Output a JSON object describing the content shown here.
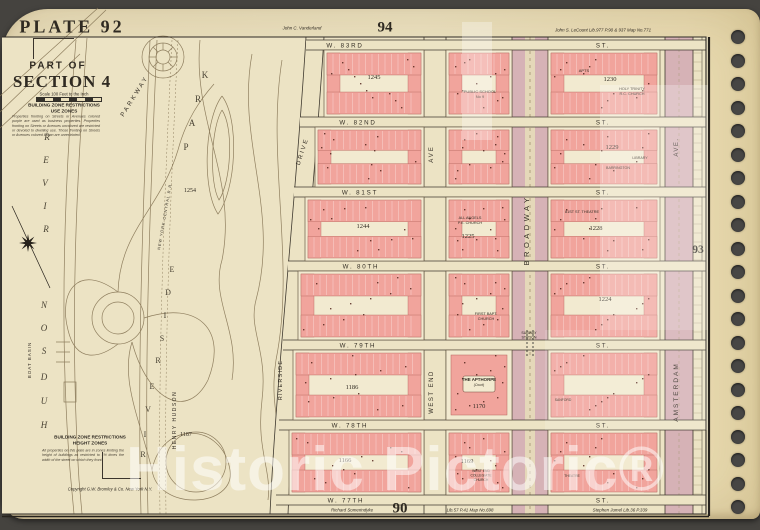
{
  "header": {
    "plate_label": "PLATE 92",
    "part_of": "PART OF",
    "section": "SECTION 4",
    "scale_note": "Scale 100 Feet to the Inch",
    "use_zone_title": "BUILDING ZONE RESTRICTIONS",
    "use_zone_sub": "USE ZONES",
    "use_zone_note": "Properties fronting on Streets or Avenues colored purple are used as business properties. Properties fronting on Streets or Avenues uncolored are restricted or devoted to dwelling use. Those fronting on Streets or Avenues colored brown are unrestricted.",
    "height_zone_title": "BUILDING ZONE RESTRICTIONS",
    "height_zone_sub": "HEIGHT ZONES",
    "height_zone_note": "All properties on this plate are in zones limiting the height of buildings as restricted to 1½ times the width of the street on which they front.",
    "copyright": "Copyright G.W. Bromley & Co. New York N.Y."
  },
  "margins": {
    "plate_top": "94",
    "plate_right": "93",
    "plate_bottom": "90",
    "top_left_text": "John C. Vanderland",
    "top_right_text": "John S. LeCount Lib.977 P.90 & 937 Map No.771",
    "bottom_text_1": "Richard Somerindyke",
    "bottom_text_2": "Lib.57 P.41 Map No.698",
    "bottom_text_3": "Stephen Jumel Lib.36 P.339"
  },
  "watermark": {
    "text": "Historic Pictoric®"
  },
  "binding": {
    "x": 731,
    "y0": 30,
    "step": 23.5,
    "count": 21
  },
  "overlays": [
    {
      "x": 462,
      "y": 22,
      "w": 30,
      "h": 118,
      "a": 0.3
    },
    {
      "x": 600,
      "y": 85,
      "w": 108,
      "h": 245,
      "a": 0.26
    },
    {
      "x": 545,
      "y": 330,
      "w": 163,
      "h": 100,
      "a": 0.14
    }
  ],
  "map": {
    "colors": {
      "face": "#ece3c4",
      "lot": "#f2ead0",
      "pink": "#f1a49c",
      "pink_edge": "#b5655c",
      "mauve": "#d6b2b6",
      "mall": "#e5d8b9",
      "dark": "#3f392f",
      "park_line": "#857454",
      "dot": "#54271e",
      "text": "#332d24"
    },
    "streets": [
      {
        "name": "W. 83RD",
        "east": "ST.",
        "y": 45,
        "x0": 306,
        "lx": 345
      },
      {
        "name": "W. 82ND",
        "east": "ST.",
        "y": 122,
        "x0": 300,
        "lx": 358
      },
      {
        "name": "W. 81ST",
        "east": "ST.",
        "y": 192,
        "x0": 294,
        "lx": 360
      },
      {
        "name": "W. 80TH",
        "east": "ST.",
        "y": 266,
        "x0": 288,
        "lx": 361
      },
      {
        "name": "W. 79TH",
        "east": "ST.",
        "y": 345,
        "x0": 283,
        "lx": 358
      },
      {
        "name": "W. 78TH",
        "east": "ST.",
        "y": 425,
        "x0": 279,
        "lx": 350
      },
      {
        "name": "W. 77TH",
        "east": "ST.",
        "y": 500,
        "x0": 276,
        "lx": 346
      }
    ],
    "east_label_x": 603,
    "riverside_drive": {
      "left": "M306,37 C296,200 276,380 270,514",
      "right": "M324,37 C314,200 294,380 288,514",
      "band": "M306,37 C296,200 276,380 270,514 L288,514 C294,380 314,200 324,37 Z"
    },
    "avenues": [
      {
        "name": "WEST END AVE",
        "x": 424,
        "w": 22,
        "kind": "plain"
      },
      {
        "name": "BROADWAY",
        "x": 512,
        "w": 36,
        "kind": "mauve",
        "mall": true
      },
      {
        "name": "AMSTERDAM AVE",
        "x": 665,
        "w": 28,
        "kind": "mauve",
        "dash": true
      }
    ],
    "vertical_labels": [
      {
        "t": "PARKWAY",
        "x": 136,
        "y": 97,
        "r": -58,
        "s": 6.2,
        "ls": 2.5
      },
      {
        "t": "DRIVE",
        "x": 304,
        "y": 152,
        "r": -72,
        "s": 6,
        "ls": 2
      },
      {
        "t": "RIVERSIDE",
        "x": 282,
        "y": 380,
        "r": -90,
        "s": 5.5,
        "ls": 1.2
      },
      {
        "t": "AVE",
        "x": 433,
        "y": 154,
        "r": -90,
        "s": 6,
        "ls": 2
      },
      {
        "t": "WEST END",
        "x": 433,
        "y": 392,
        "r": -90,
        "s": 6,
        "ls": 1.5
      },
      {
        "t": "BROADWAY",
        "x": 529,
        "y": 230,
        "r": -90,
        "s": 7.5,
        "ls": 3.5
      },
      {
        "t": "AVE.",
        "x": 678,
        "y": 147,
        "r": -90,
        "s": 6,
        "ls": 1.5
      },
      {
        "t": "AMSTERDAM",
        "x": 678,
        "y": 392,
        "r": -90,
        "s": 6.5,
        "ls": 2
      },
      {
        "t": "HENRY HUDSON",
        "x": 176,
        "y": 420,
        "r": -90,
        "s": 5,
        "ls": 1.5
      },
      {
        "t": "NEW YORK CENTRAL R.R.",
        "x": 166,
        "y": 216,
        "r": -80,
        "s": 3.8,
        "ls": 1
      },
      {
        "t": "BOAT BASIN",
        "x": 31,
        "y": 360,
        "r": -90,
        "s": 4.5,
        "ls": 1
      }
    ],
    "park": {
      "paths": [
        "M0,96 L98,8",
        "M0,112 L106,10",
        "M0,128 L80,54",
        "M76,40 C66,160 58,320 70,470 L74,514",
        "M87,38 C77,170 69,320 79,480 L82,514",
        "M150,40 C143,200 137,360 141,514",
        "M157,40 C150,200 144,360 148,514",
        "M118,292 C78,262 58,292 68,330 C76,364 100,358 118,344",
        "M144,318 C198,300 228,330 208,380 C188,420 148,402 132,342",
        "M152,470 C162,420 222,422 230,470 C236,508 158,512 152,470",
        "M222,96 C240,120 236,190 218,214 C202,190 204,120 222,96",
        "M222,110 C234,128 231,182 219,200 C209,182 211,128 222,110",
        "M200,40 C192,120 238,180 222,260 C210,300 240,330 232,380",
        "M252,54 C236,140 280,210 256,300 C248,330 268,350 262,400 C256,450 272,470 268,500",
        "M282,60 C266,160 296,260 276,360 C268,410 286,440 282,490",
        "M118,292 C120,230 160,210 178,150 C186,120 200,100 214,84",
        "M132,342 C120,380 140,420 152,470",
        "M56,342 h14 M56,352 h14 M56,362 h14",
        "M64,382 h12 v20 h-12 Z"
      ],
      "rail": [
        "M172,40 C164,200 158,360 160,514",
        "M178,40 C170,200 164,360 166,514"
      ],
      "circles": [
        {
          "x": 163,
          "y": 57,
          "r": [
            21,
            14,
            7
          ],
          "spokes": 8
        },
        {
          "x": 118,
          "y": 318,
          "r": [
            26,
            16
          ],
          "spokes": 0
        },
        {
          "x": 196,
          "y": 462,
          "r": [
            30
          ],
          "spokes": 0
        }
      ],
      "words": [
        {
          "name": "river",
          "s": 9,
          "it": true,
          "letters": [
            [
              "R",
              47,
              140
            ],
            [
              "E",
              46,
              163
            ],
            [
              "V",
              45,
              186
            ],
            [
              "I",
              45,
              209
            ],
            [
              "R",
              46,
              232
            ]
          ]
        },
        {
          "name": "hudson",
          "s": 9,
          "it": true,
          "letters": [
            [
              "N",
              44,
              308
            ],
            [
              "O",
              44,
              331
            ],
            [
              "S",
              44,
              354
            ],
            [
              "D",
              44,
              380
            ],
            [
              "U",
              44,
              404
            ],
            [
              "H",
              44,
              428
            ]
          ]
        },
        {
          "name": "park",
          "s": 9,
          "it": false,
          "letters": [
            [
              "K",
              205,
              78
            ],
            [
              "R",
              198,
              102
            ],
            [
              "A",
              192,
              126
            ],
            [
              "P",
              186,
              150
            ]
          ]
        },
        {
          "name": "riverside-arc",
          "s": 8,
          "it": false,
          "letters": [
            [
              "E",
              172,
              272
            ],
            [
              "D",
              168,
              295
            ],
            [
              "I",
              165,
              318
            ],
            [
              "S",
              162,
              341
            ],
            [
              "R",
              158,
              363
            ],
            [
              "E",
              152,
              389
            ],
            [
              "V",
              148,
              412
            ],
            [
              "I",
              145,
              437
            ],
            [
              "R",
              143,
              457
            ]
          ]
        }
      ],
      "numbers": [
        {
          "t": "1254",
          "x": 190,
          "y": 192
        },
        {
          "t": "1187",
          "x": 186,
          "y": 436
        }
      ],
      "compass": {
        "x": 28,
        "y": 243,
        "line": [
          12,
          206,
          50,
          288
        ]
      }
    },
    "subway": {
      "lines": [
        "SUBWAY",
        "STATION"
      ],
      "x": 529,
      "y": 334
    },
    "blocks": [
      {
        "id": "A1",
        "x": 324,
        "y": 50,
        "w": 100,
        "h": 67,
        "num": "1245",
        "nx": 50,
        "ny": 29,
        "labels": []
      },
      {
        "id": "B1",
        "x": 446,
        "y": 50,
        "w": 66,
        "h": 67,
        "labels": [
          {
            "t": "PUBLIC SCHOOL|No 9",
            "x": 34,
            "y": 43,
            "s": 4
          }
        ]
      },
      {
        "id": "C1",
        "x": 548,
        "y": 50,
        "w": 112,
        "h": 67,
        "num": "1230",
        "nx": 62,
        "ny": 31,
        "labels": [
          {
            "t": "APTS",
            "x": 36,
            "y": 22,
            "s": 4
          },
          {
            "t": "HOLY TRINITY|R.C. CHURCH",
            "x": 84,
            "y": 40,
            "s": 3.8
          }
        ]
      },
      {
        "id": "A2",
        "x": 315,
        "y": 127,
        "w": 109,
        "h": 60,
        "labels": []
      },
      {
        "id": "B2",
        "x": 446,
        "y": 127,
        "w": 66,
        "h": 60,
        "labels": []
      },
      {
        "id": "C2",
        "x": 548,
        "y": 127,
        "w": 112,
        "h": 60,
        "num": "1229",
        "nx": 64,
        "ny": 22,
        "labels": [
          {
            "t": "LIBRARY",
            "x": 92,
            "y": 32,
            "s": 3.6
          },
          {
            "t": "BARRINGTON",
            "x": 70,
            "y": 42,
            "s": 3.6
          }
        ]
      },
      {
        "id": "A3",
        "x": 305,
        "y": 197,
        "w": 119,
        "h": 64,
        "num": "1244",
        "nx": 58,
        "ny": 31,
        "labels": []
      },
      {
        "id": "B3",
        "x": 446,
        "y": 197,
        "w": 66,
        "h": 64,
        "num": "1225",
        "nx": 22,
        "ny": 41,
        "labels": [
          {
            "t": "ALL ANGELS|P.E. CHURCH",
            "x": 24,
            "y": 22,
            "s": 3.8
          }
        ]
      },
      {
        "id": "C3",
        "x": 548,
        "y": 197,
        "w": 112,
        "h": 64,
        "num": "1228",
        "nx": 48,
        "ny": 33,
        "labels": [
          {
            "t": "81ST ST. THEATRE",
            "x": 34,
            "y": 16,
            "s": 3.8
          }
        ]
      },
      {
        "id": "A4",
        "x": 298,
        "y": 271,
        "w": 126,
        "h": 69,
        "labels": []
      },
      {
        "id": "B4",
        "x": 446,
        "y": 271,
        "w": 66,
        "h": 69,
        "labels": [
          {
            "t": "FIRST BAPT.|CHURCH",
            "x": 40,
            "y": 44,
            "s": 3.8
          }
        ]
      },
      {
        "id": "C4",
        "x": 548,
        "y": 271,
        "w": 112,
        "h": 69,
        "num": "1224",
        "nx": 57,
        "ny": 30,
        "labels": []
      },
      {
        "id": "A5",
        "x": 293,
        "y": 350,
        "w": 131,
        "h": 70,
        "num": "1186",
        "nx": 59,
        "ny": 39,
        "labels": []
      },
      {
        "id": "B5",
        "x": 446,
        "y": 350,
        "w": 66,
        "h": 70,
        "style": "court",
        "num": "1170",
        "nx": 33,
        "ny": 58,
        "court": "(Court)",
        "labels": [
          {
            "t": "THE APTHORPE",
            "x": 33,
            "y": 31,
            "s": 4.4,
            "b": true
          }
        ]
      },
      {
        "id": "C5",
        "x": 548,
        "y": 350,
        "w": 112,
        "h": 70,
        "labels": [
          {
            "t": "SANFORD",
            "x": 15,
            "y": 51,
            "s": 3.4
          }
        ]
      },
      {
        "id": "A6",
        "x": 289,
        "y": 430,
        "w": 135,
        "h": 65,
        "num": "1166",
        "nx": 56,
        "ny": 32,
        "labels": []
      },
      {
        "id": "B6",
        "x": 446,
        "y": 430,
        "w": 66,
        "h": 65,
        "num": "1169",
        "nx": 21,
        "ny": 33,
        "labels": [
          {
            "t": "WEST END|COLLEGIATE|CHURCH",
            "x": 35,
            "y": 42,
            "s": 3.4
          }
        ]
      },
      {
        "id": "C6",
        "x": 548,
        "y": 430,
        "w": 112,
        "h": 65,
        "labels": [
          {
            "t": "THEATRE",
            "x": 24,
            "y": 47,
            "s": 3.4
          }
        ]
      }
    ]
  }
}
